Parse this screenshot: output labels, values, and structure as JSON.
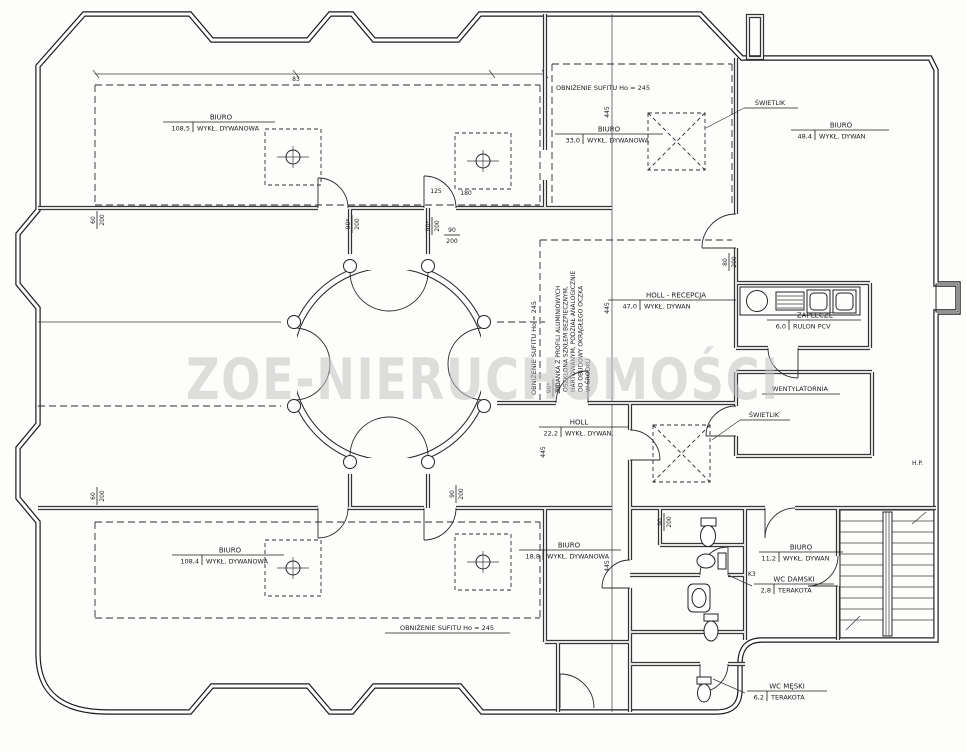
{
  "watermark": {
    "text": "ZOE-NIERUCHOMOŚCI",
    "color": "#c3c3c3"
  },
  "rooms": [
    {
      "name": "BIURO",
      "area": "108,5",
      "floor": "WYKŁ. DYWANOWA"
    },
    {
      "name": "BIURO",
      "area": "33,0",
      "floor": "WYKŁ. DYWANOWA"
    },
    {
      "name": "BIURO",
      "area": "48,4",
      "floor": "WYKŁ. DYWAN"
    },
    {
      "name": "HOLL - RECEPCJA",
      "area": "47,0",
      "floor": "WYKŁ. DYWAN"
    },
    {
      "name": "ZAPLECZE",
      "area": "6,0",
      "floor": "RULON PCV"
    },
    {
      "name": "HOLL",
      "area": "22,2",
      "floor": "WYKŁ. DYWAN."
    },
    {
      "name": "BIURO",
      "area": "108,4",
      "floor": "WYKŁ. DYWANOWA"
    },
    {
      "name": "BIURO",
      "area": "18,8",
      "floor": "WYKŁ. DYWANOWA"
    },
    {
      "name": "BIURO",
      "area": "11,2",
      "floor": "WYKŁ. DYWAN"
    },
    {
      "name": "WC DAMSKI",
      "area": "2,8",
      "floor": "TERAKOTA"
    },
    {
      "name": "WC MĘSKI",
      "area": "6,2",
      "floor": "TERAKOTA"
    }
  ],
  "annotations": {
    "ceiling_top": "OBNIŻENIE SUFITU Ho = 245",
    "ceiling_bottom": "OBNIŻENIE SUFITU Ho = 245",
    "ceiling_side": "OBNIŻENIE SUFITU Ho = 245",
    "skylight": "ŚWIETLIK",
    "vent_room": "WENTYLATORNIA",
    "wall_note": [
      "ŚCIANKA Z PROFILI ALUMINIOWYCH",
      "OSZKLONA SZKŁEM BEZPIECZNYM,",
      "HARTOWANYM, PODZIAŁ ANALOGICZNIE",
      "DO OBUDOWY OKRĄGŁEGO OCZKA",
      "W ŚRODKU"
    ]
  },
  "dims": {
    "w90s": "90*",
    "w90": "90",
    "h200": "200",
    "w60": "60",
    "w80": "80",
    "d445": "445",
    "d180": "180",
    "d125": "125",
    "d83": "83",
    "k3": "K3",
    "hp": "H.P."
  }
}
